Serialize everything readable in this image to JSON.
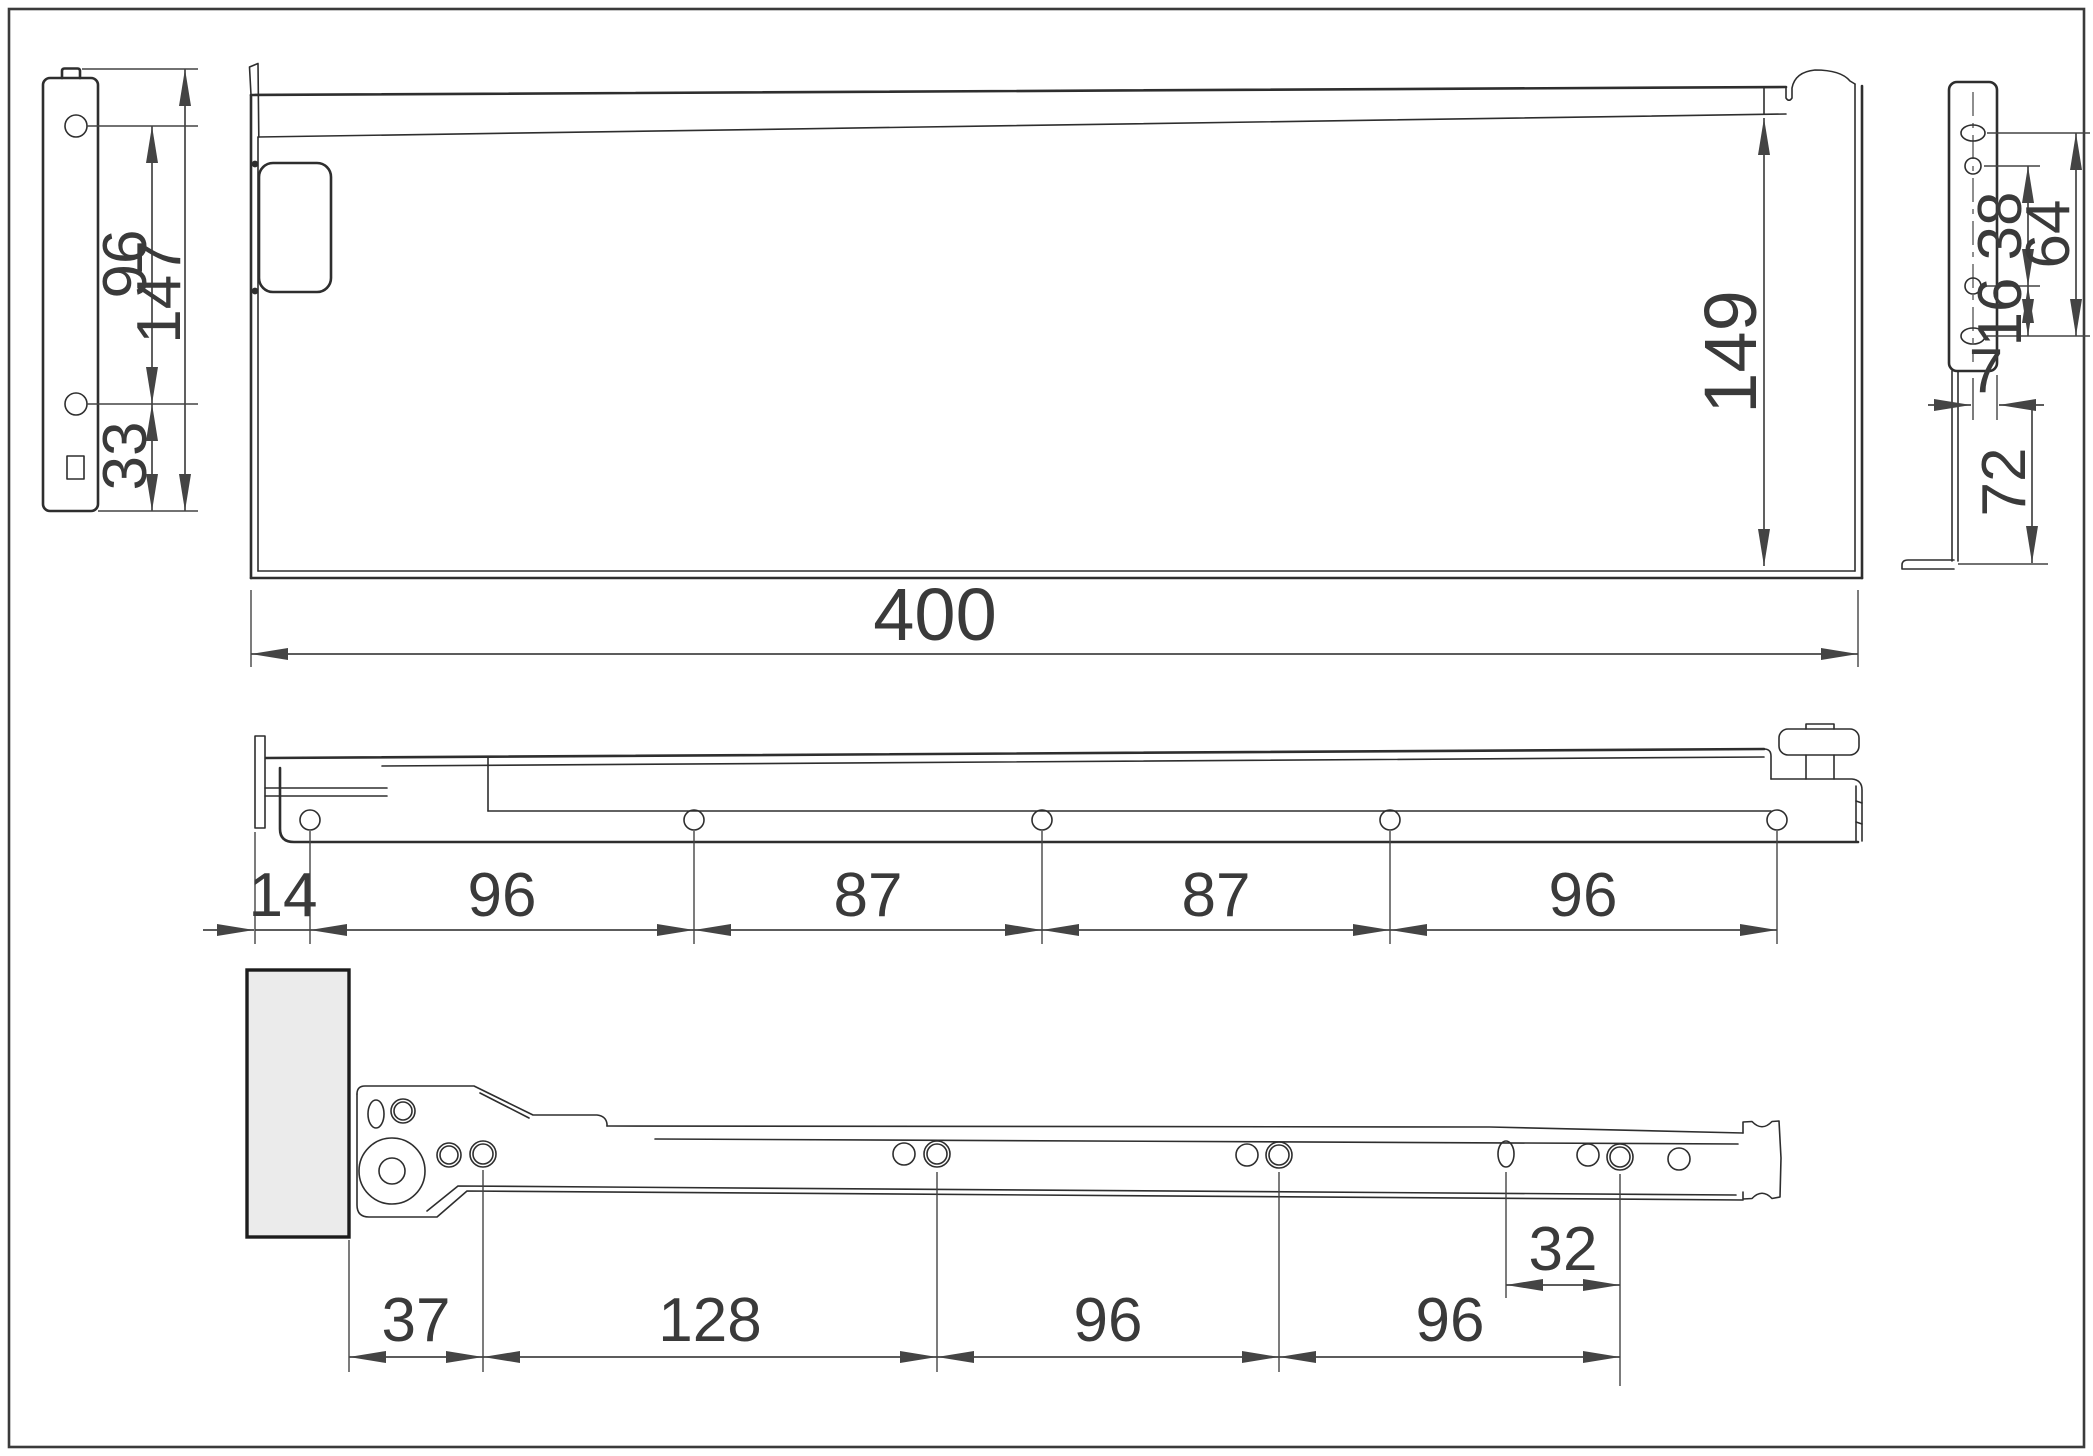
{
  "title": "Drawer metal side panel and roller slide - dimensioned technical drawing",
  "colors": {
    "line": "#2e2e2e",
    "dim": "#444444",
    "text": "#3a3a3a",
    "wood": "#ebebeb",
    "bg": "#ffffff",
    "frame": "#3b3b3b"
  },
  "views": {
    "front_bracket": {
      "name": "rear fixing bracket - front view",
      "dims": {
        "hole_spacing": "96",
        "height": "147",
        "bottom_hole_offset": "33"
      }
    },
    "side_panel": {
      "name": "drawer side panel - side view",
      "dims": {
        "height": "149",
        "length": "400"
      }
    },
    "rail_hole_pattern": {
      "name": "panel bottom rail - hole pattern",
      "dims": {
        "lead": "14",
        "s1": "96",
        "s2": "87",
        "s3": "87",
        "s4": "96"
      }
    },
    "rear_bracket_side": {
      "name": "rear bracket - side view",
      "dims": {
        "upper_span": "38",
        "overall_span": "64",
        "lower_span": "16",
        "offset": "7",
        "leg": "72"
      }
    },
    "slide_hole_pattern": {
      "name": "cabinet roller slide - hole pattern",
      "dims": {
        "lead": "37",
        "s1": "128",
        "s2": "96",
        "s3": "96",
        "pitch": "32"
      }
    }
  }
}
